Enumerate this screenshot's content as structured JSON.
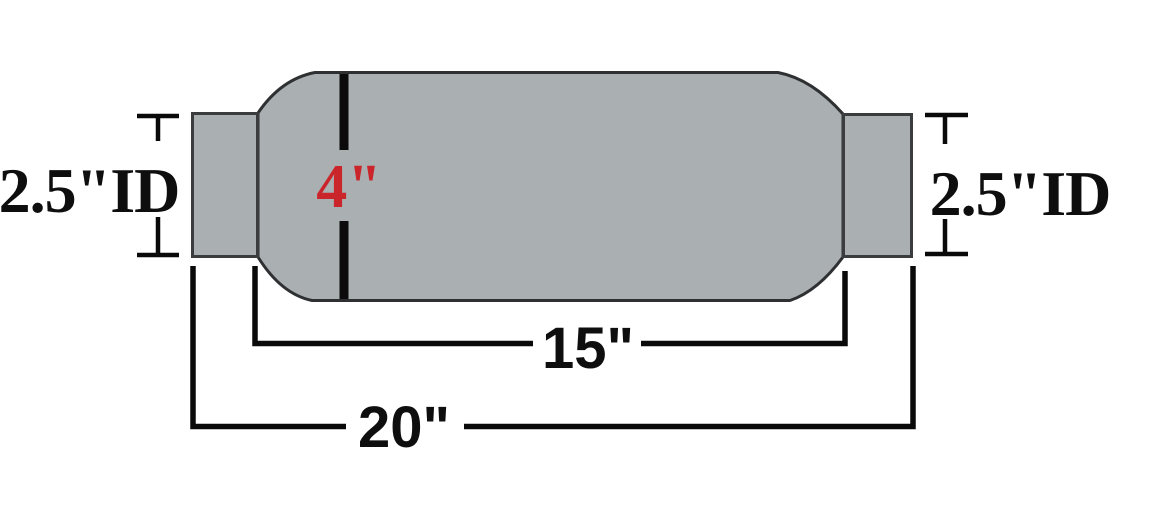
{
  "labels": {
    "inlet_id": "2.5\"ID",
    "outlet_id": "2.5\"ID",
    "body_diameter": "4\"",
    "body_length": "15\"",
    "overall_length": "20\""
  },
  "colors": {
    "background": "#ffffff",
    "metal_fill": "#aaafb1",
    "metal_outline": "#2e3032",
    "dimension_lines": "#0a0a0a",
    "diameter_label_color": "#c9252b",
    "label_text_color": "#0e0e0e"
  }
}
